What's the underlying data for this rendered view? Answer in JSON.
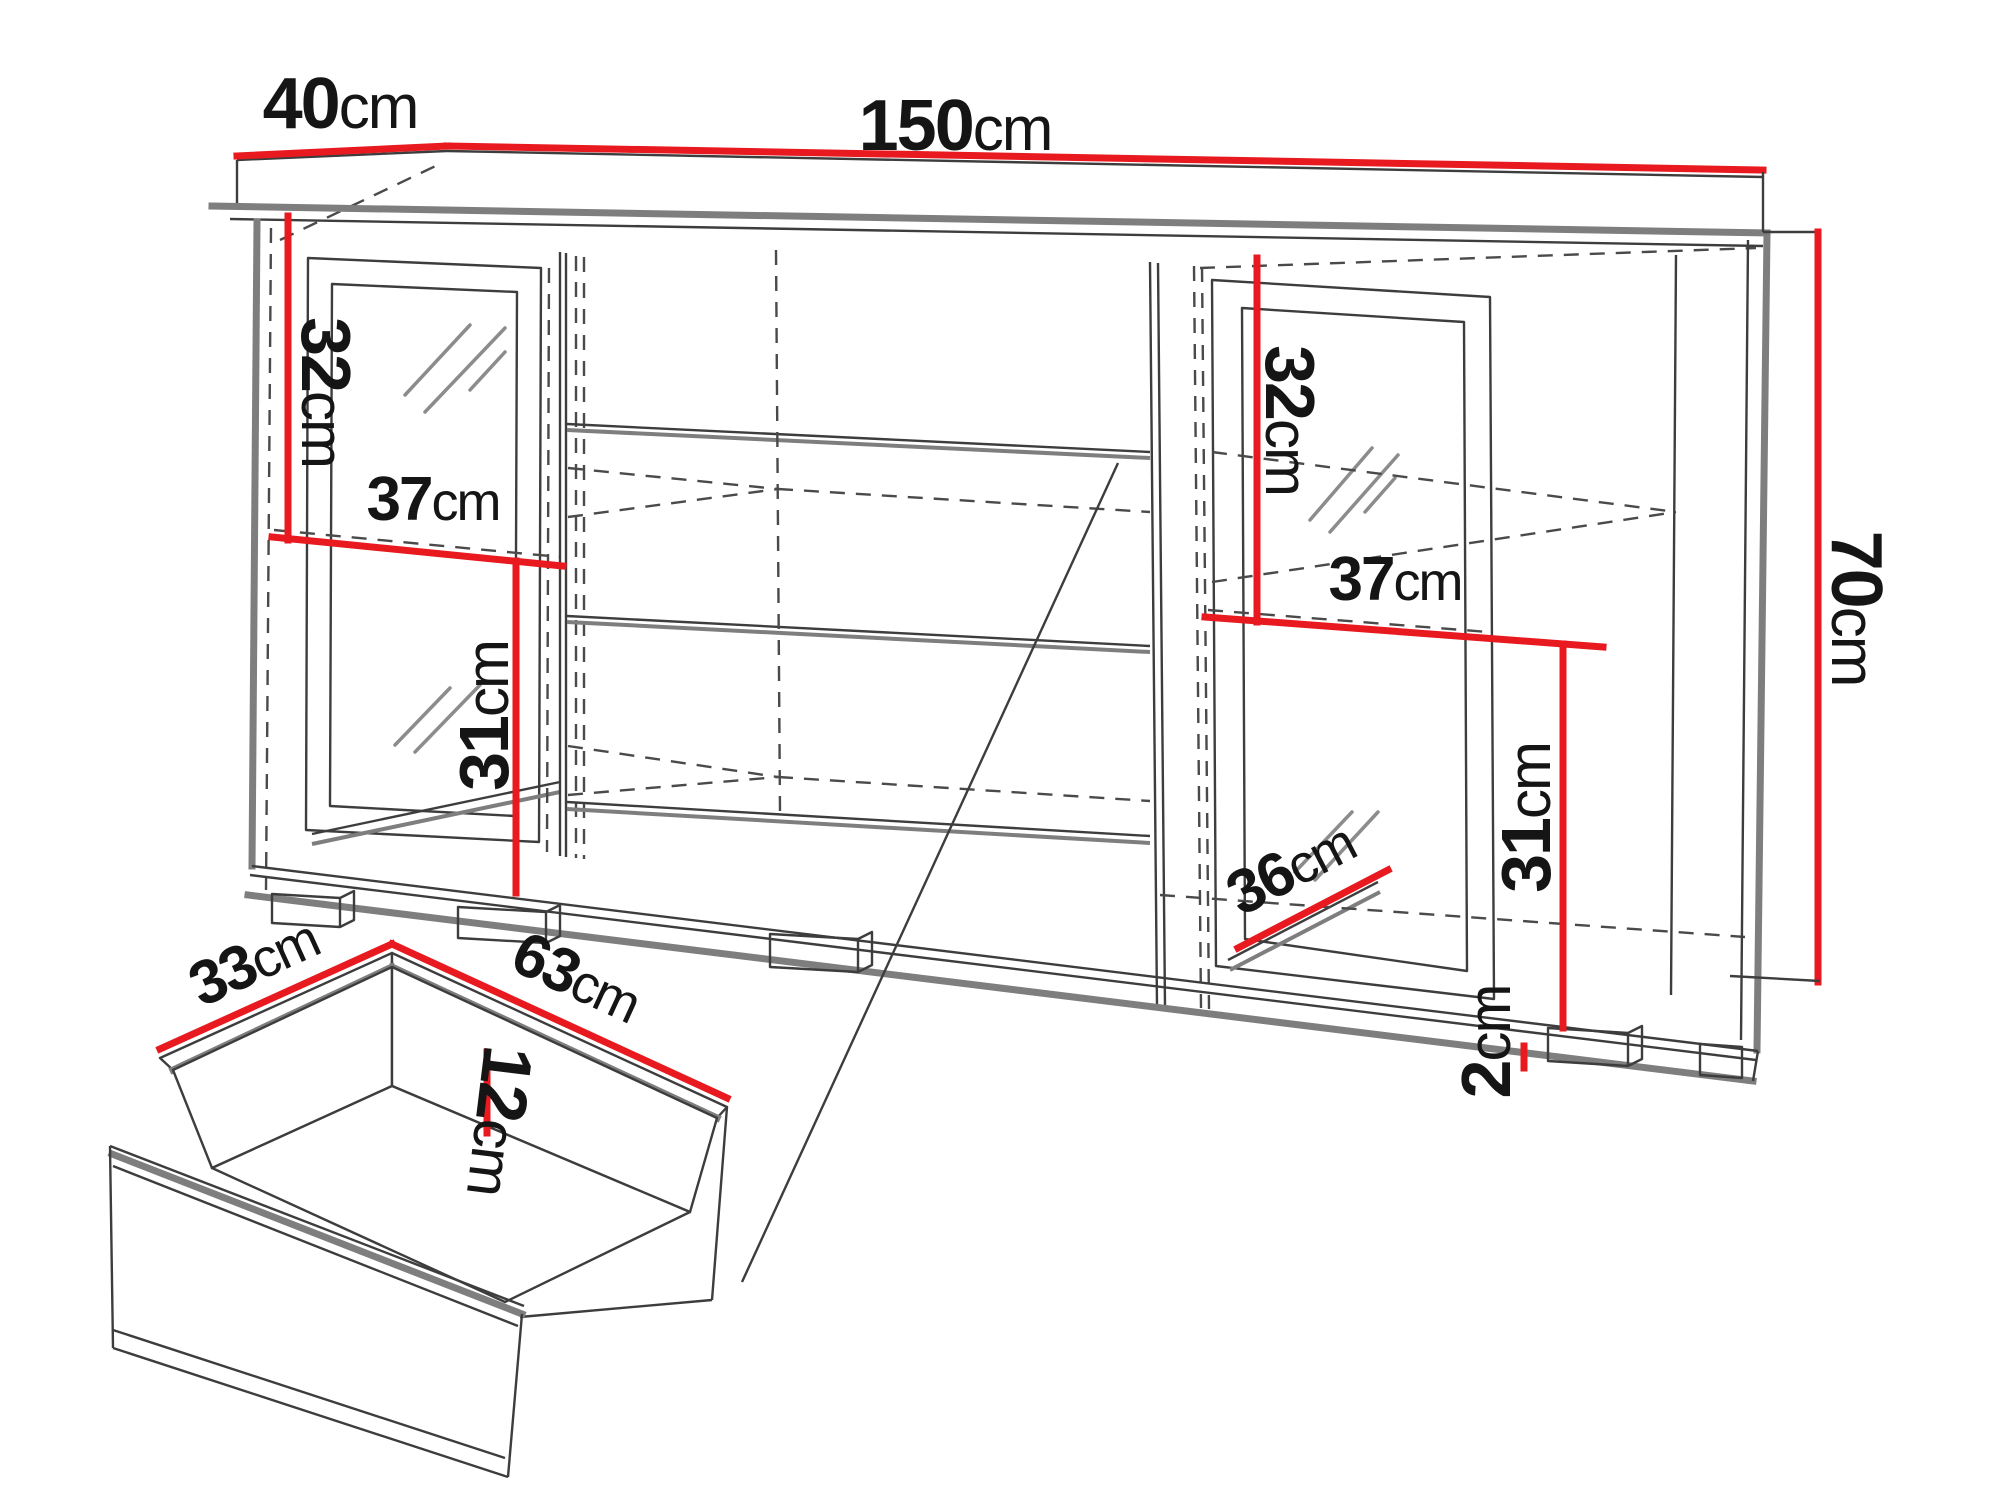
{
  "diagram": {
    "type": "furniture-dimension-diagram",
    "subject": "sideboard with two glass doors, open middle shelves and a pull-out drawer detail"
  },
  "colors": {
    "background": "#ffffff",
    "dimension_red": "#e8191f",
    "outline_gray": "#7e7e7e",
    "outline_dark": "#3d3d3d",
    "label_text": "#151515"
  },
  "cabinet": {
    "width": {
      "value": "150",
      "unit": "cm"
    },
    "depth": {
      "value": "40",
      "unit": "cm"
    },
    "height": {
      "value": "70",
      "unit": "cm"
    },
    "left_compartment": {
      "upper_height": {
        "value": "32",
        "unit": "cm"
      },
      "interior_width": {
        "value": "37",
        "unit": "cm"
      },
      "lower_height": {
        "value": "31",
        "unit": "cm"
      }
    },
    "right_compartment": {
      "upper_height": {
        "value": "32",
        "unit": "cm"
      },
      "interior_width": {
        "value": "37",
        "unit": "cm"
      },
      "lower_height": {
        "value": "31",
        "unit": "cm"
      },
      "interior_depth": {
        "value": "36",
        "unit": "cm"
      },
      "plinth_height": {
        "value": "2",
        "unit": "cm"
      }
    }
  },
  "drawer": {
    "depth": {
      "value": "33",
      "unit": "cm"
    },
    "width": {
      "value": "63",
      "unit": "cm"
    },
    "height": {
      "value": "12",
      "unit": "cm"
    }
  }
}
